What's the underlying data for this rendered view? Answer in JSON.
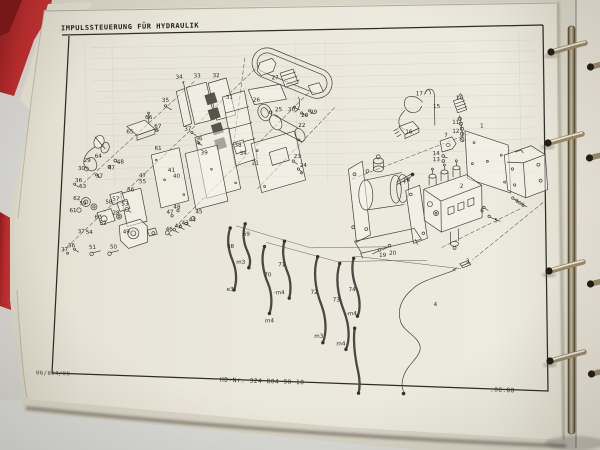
{
  "doc": {
    "title": "IMPULSSTEUERUNG FÜR HYDRAULIK",
    "footer": {
      "left": "06/804/00",
      "center": "HD-Nr. 324 804 90 10",
      "right": ".06.88"
    }
  },
  "colors": {
    "binder_red": "#b32729",
    "paper": "#eae7db",
    "ink": "#45423b",
    "backdrop": "#d5d4d0",
    "ring_metal": "#9a8a6a"
  },
  "diagram": {
    "labels": [
      {
        "t": "34",
        "x": 181,
        "y": 77
      },
      {
        "t": "33",
        "x": 199,
        "y": 76
      },
      {
        "t": "32",
        "x": 218,
        "y": 76
      },
      {
        "t": "35",
        "x": 167,
        "y": 100
      },
      {
        "t": "31",
        "x": 231,
        "y": 98
      },
      {
        "t": "26",
        "x": 258,
        "y": 101
      },
      {
        "t": "27",
        "x": 277,
        "y": 79
      },
      {
        "t": "25",
        "x": 280,
        "y": 111
      },
      {
        "t": "30",
        "x": 293,
        "y": 111
      },
      {
        "t": "28",
        "x": 306,
        "y": 117
      },
      {
        "t": "29",
        "x": 315,
        "y": 114
      },
      {
        "t": "22",
        "x": 303,
        "y": 127
      },
      {
        "t": "66",
        "x": 150,
        "y": 117
      },
      {
        "t": "67",
        "x": 159,
        "y": 126
      },
      {
        "t": "65",
        "x": 131,
        "y": 131
      },
      {
        "t": "37",
        "x": 189,
        "y": 129
      },
      {
        "t": "36",
        "x": 200,
        "y": 139
      },
      {
        "t": "38",
        "x": 239,
        "y": 146
      },
      {
        "t": "34",
        "x": 244,
        "y": 154
      },
      {
        "t": "21",
        "x": 256,
        "y": 164
      },
      {
        "t": "23",
        "x": 298,
        "y": 158
      },
      {
        "t": "24",
        "x": 304,
        "y": 167
      },
      {
        "t": "61",
        "x": 159,
        "y": 148
      },
      {
        "t": "39",
        "x": 205,
        "y": 153
      },
      {
        "t": "64",
        "x": 99,
        "y": 155
      },
      {
        "t": "29",
        "x": 88,
        "y": 159
      },
      {
        "t": "30",
        "x": 82,
        "y": 167
      },
      {
        "t": "48",
        "x": 121,
        "y": 161
      },
      {
        "t": "47",
        "x": 112,
        "y": 167
      },
      {
        "t": "17",
        "x": 421,
        "y": 97
      },
      {
        "t": "15",
        "x": 438,
        "y": 110
      },
      {
        "t": "10",
        "x": 461,
        "y": 102
      },
      {
        "t": "11",
        "x": 457,
        "y": 126
      },
      {
        "t": "12",
        "x": 457,
        "y": 135
      },
      {
        "t": "16",
        "x": 410,
        "y": 135
      },
      {
        "t": "7",
        "x": 447,
        "y": 139
      },
      {
        "t": "1",
        "x": 483,
        "y": 130
      },
      {
        "t": "14",
        "x": 437,
        "y": 157
      },
      {
        "t": "13",
        "x": 437,
        "y": 163
      },
      {
        "t": "18",
        "x": 407,
        "y": 183
      },
      {
        "t": "2",
        "x": 462,
        "y": 190
      },
      {
        "t": "9",
        "x": 517,
        "y": 206
      },
      {
        "t": "8",
        "x": 523,
        "y": 210
      },
      {
        "t": "6",
        "x": 482,
        "y": 215
      },
      {
        "t": "5",
        "x": 496,
        "y": 225
      },
      {
        "t": "19",
        "x": 382,
        "y": 258
      },
      {
        "t": "20",
        "x": 392,
        "y": 256
      },
      {
        "t": "3",
        "x": 467,
        "y": 265
      },
      {
        "t": "4",
        "x": 434,
        "y": 308
      },
      {
        "t": "37",
        "x": 100,
        "y": 175
      },
      {
        "t": "36",
        "x": 79,
        "y": 179
      },
      {
        "t": "63",
        "x": 83,
        "y": 185
      },
      {
        "t": "62",
        "x": 77,
        "y": 197
      },
      {
        "t": "59",
        "x": 83,
        "y": 202
      },
      {
        "t": "61",
        "x": 73,
        "y": 209
      },
      {
        "t": "60",
        "x": 98,
        "y": 216
      },
      {
        "t": "57",
        "x": 116,
        "y": 198
      },
      {
        "t": "58",
        "x": 109,
        "y": 201
      },
      {
        "t": "53",
        "x": 125,
        "y": 203
      },
      {
        "t": "28",
        "x": 116,
        "y": 212
      },
      {
        "t": "56",
        "x": 131,
        "y": 189
      },
      {
        "t": "55",
        "x": 143,
        "y": 181
      },
      {
        "t": "47",
        "x": 143,
        "y": 175
      },
      {
        "t": "40",
        "x": 177,
        "y": 176
      },
      {
        "t": "41",
        "x": 172,
        "y": 170
      },
      {
        "t": "52",
        "x": 103,
        "y": 222
      },
      {
        "t": "54",
        "x": 89,
        "y": 231
      },
      {
        "t": "37",
        "x": 81,
        "y": 230
      },
      {
        "t": "49",
        "x": 126,
        "y": 231
      },
      {
        "t": "36",
        "x": 71,
        "y": 244
      },
      {
        "t": "37",
        "x": 64,
        "y": 248
      },
      {
        "t": "51",
        "x": 92,
        "y": 246
      },
      {
        "t": "50",
        "x": 113,
        "y": 246
      },
      {
        "t": "48",
        "x": 177,
        "y": 207
      },
      {
        "t": "47",
        "x": 170,
        "y": 212
      },
      {
        "t": "46",
        "x": 169,
        "y": 229
      },
      {
        "t": "42",
        "x": 178,
        "y": 226
      },
      {
        "t": "43",
        "x": 185,
        "y": 223
      },
      {
        "t": "44",
        "x": 192,
        "y": 220
      },
      {
        "t": "45",
        "x": 199,
        "y": 212
      },
      {
        "t": "69",
        "x": 246,
        "y": 235
      },
      {
        "t": "68",
        "x": 230,
        "y": 247
      },
      {
        "t": "71",
        "x": 281,
        "y": 266
      },
      {
        "t": "70",
        "x": 267,
        "y": 276
      },
      {
        "t": "72",
        "x": 313,
        "y": 294
      },
      {
        "t": "73",
        "x": 335,
        "y": 302
      },
      {
        "t": "74",
        "x": 351,
        "y": 292
      },
      {
        "t": "m3",
        "x": 240,
        "y": 263
      },
      {
        "t": "e3",
        "x": 229,
        "y": 290
      },
      {
        "t": "-m4",
        "x": 278,
        "y": 294
      },
      {
        "t": "m4",
        "x": 268,
        "y": 322
      },
      {
        "t": "m3",
        "x": 317,
        "y": 338
      },
      {
        "t": "m4",
        "x": 339,
        "y": 346
      },
      {
        "t": "-m4",
        "x": 350,
        "y": 316
      }
    ]
  }
}
